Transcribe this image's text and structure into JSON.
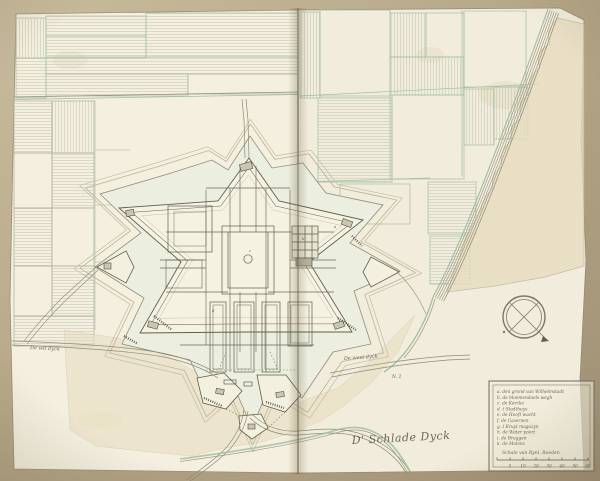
{
  "document": {
    "kind": "manuscript fortification plan in bound atlas",
    "subject": "star-shaped bastioned fortress with moat, ravelins, outworks, surrounding field parcels, dike and river bank"
  },
  "annotations": {
    "road_left": "De wit dyck",
    "road_right": "De west dyck",
    "marker_n2": "N. 2",
    "signature": "D' Schlade Dyck",
    "letter_a": "a",
    "letter_b": "b",
    "letter_c": "c",
    "letter_d": "d"
  },
  "legend": {
    "entries": [
      "a. den grond van Wilhelmstadt",
      "b. de bloemendaels wegh",
      "c. de Kercke",
      "d. t Stadthuys",
      "e. de Hooft wacht",
      "f. de Casernen",
      "g. t Kruyt magazyn",
      "h. de Water poort",
      "i. de Bruggen",
      "k. de Molens"
    ],
    "scale_caption": "Schale van Rynl. Roeden",
    "scale_ticks": [
      "5",
      "10",
      "20",
      "30",
      "40",
      "50",
      "60"
    ]
  },
  "compass": {
    "style": "double circle with diagonal cross and pointer"
  },
  "colors": {
    "paper": "#f3eede",
    "background": "#b2a384",
    "ink": "#5f5e4f",
    "field_boundary_green": "#9dbf9e",
    "moat": "#ecefdf",
    "glacis_tan": "#e7dcbd"
  }
}
